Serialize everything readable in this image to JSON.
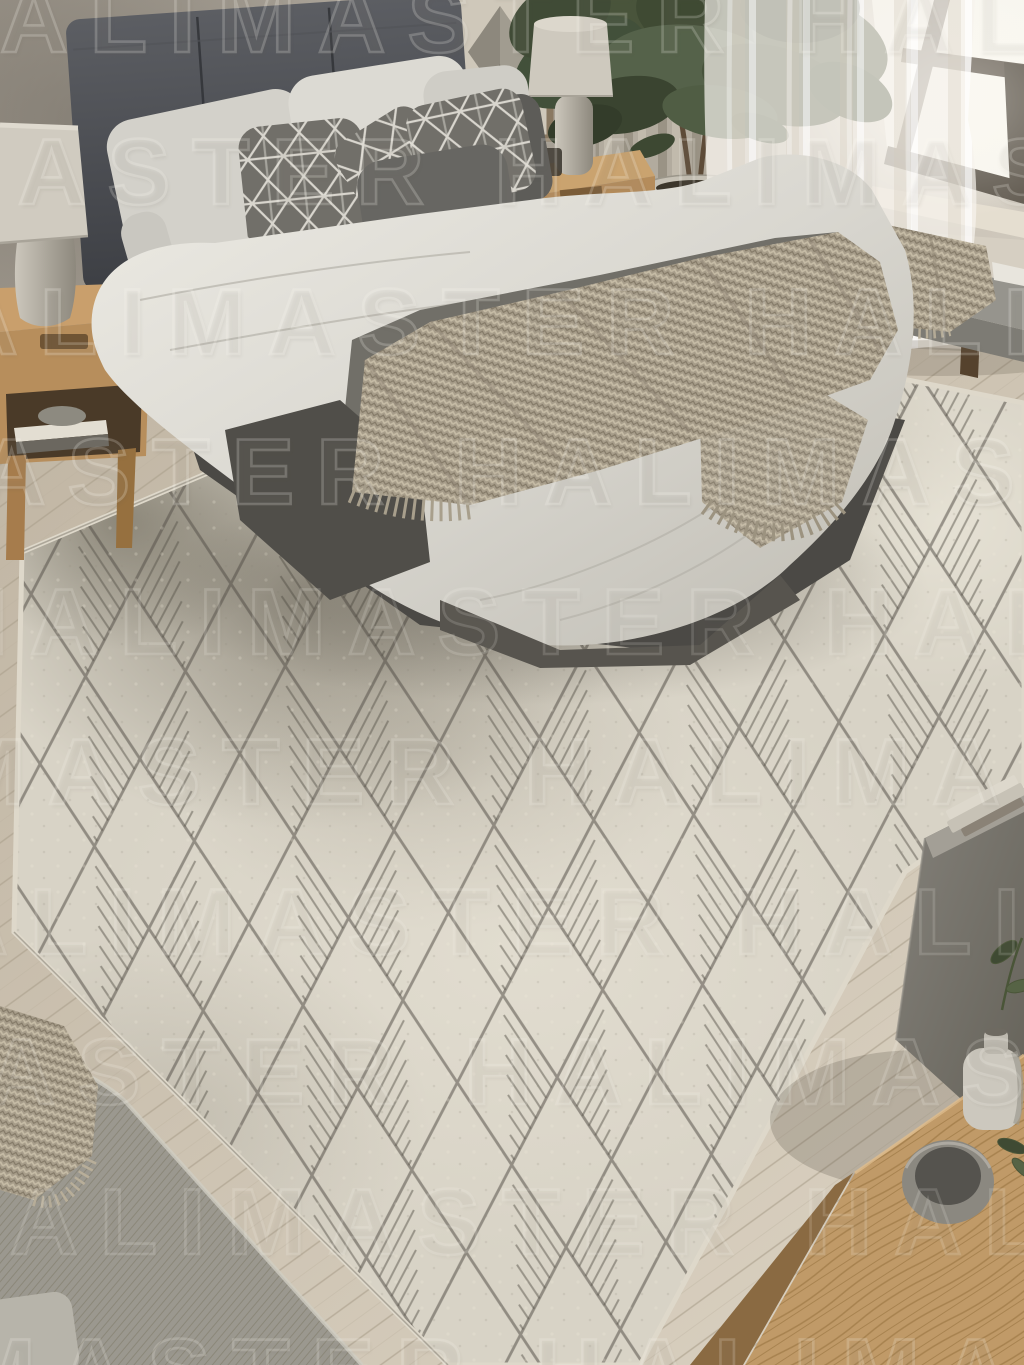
{
  "image": {
    "kind": "rendered product photograph",
    "subject": "bedroom with geometric diamond-pattern area rug",
    "width_px": 1024,
    "height_px": 1365
  },
  "watermark": {
    "text": "HALIMASTER",
    "row_text": "HALIMASTER HALIMASTER HALIMASTER"
  },
  "scene": {
    "objects": [
      "upholstered headboard",
      "bed with white duvet",
      "white pillows",
      "geometric patterned pillows",
      "dark gray pillows",
      "dark gray bed runner",
      "chunky knit throw",
      "wood nightstand left",
      "wood nightstand right",
      "stone table lamp left",
      "stone table lamp right",
      "framed geometric artwork",
      "potted ficus tree",
      "stone planter",
      "beige curtain",
      "sheer white curtain",
      "window with dark frame",
      "upholstered bench with knit throw",
      "diamond lattice area rug",
      "light wood plank floor",
      "gray sofa corner",
      "knit throw on sofa",
      "concrete side table with books",
      "wood coffee table",
      "stone bowl",
      "ceramic jug",
      "green plant sprigs"
    ]
  },
  "palette": {
    "wall": "#b3aca0",
    "window_glow": "#f7f5ee",
    "window_frame": "#675f53",
    "headboard": "#4e5055",
    "bedding_white": "#dedcd5",
    "runner_dark": "#6f6d66",
    "throw_taupe": "#a79d8a",
    "wood_light": "#c29a68",
    "plant_green": "#49543b",
    "rug_base": "#d8d3c6",
    "rug_line": "#56524a",
    "floor": "#ccc2b1",
    "sofa_gray": "#9b988f",
    "concrete": "#7e7b74"
  }
}
